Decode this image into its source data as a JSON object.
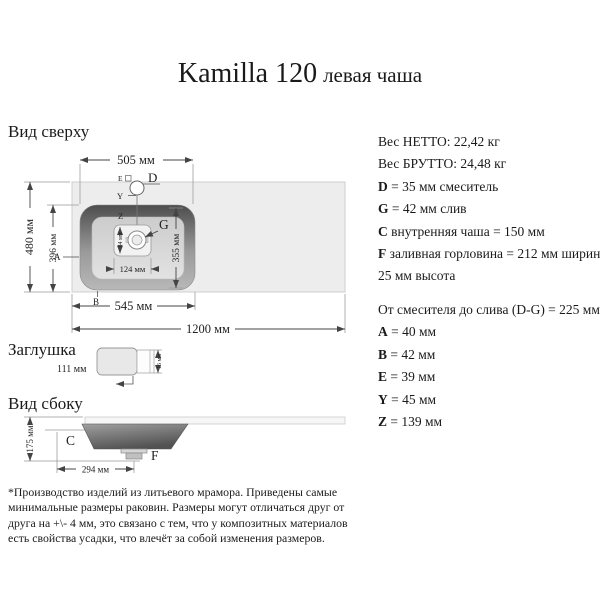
{
  "title": {
    "main": "Kamilla 120",
    "sub": "левая чаша"
  },
  "top_view": {
    "heading": "Вид сверху",
    "dims": {
      "bowl_width": "505 мм",
      "counter_height": "480 мм",
      "inner_height": "396 мм",
      "bowl_inner_depth": "355 мм",
      "drain_width": "124 мм",
      "drain_height": "84 мм",
      "left_width": "545 мм",
      "total_width": "1200 мм"
    },
    "labels": {
      "d": "D",
      "e": "E",
      "y": "Y",
      "z": "Z",
      "g": "G",
      "a": "A",
      "b": "B"
    }
  },
  "plug": {
    "heading": "Заглушка",
    "dims": {
      "width": "111 мм",
      "height": "16 мм"
    }
  },
  "side_view": {
    "heading": "Вид сбоку",
    "dims": {
      "height": "175 мм",
      "drain_offset": "294 мм"
    },
    "labels": {
      "c": "C",
      "f": "F"
    }
  },
  "specs1": [
    {
      "b": "",
      "t": "Вес НЕТТО: 22,42 кг"
    },
    {
      "b": "",
      "t": "Вес БРУТТО: 24,48 кг"
    },
    {
      "b": "D",
      "t": " = 35 мм смеситель"
    },
    {
      "b": "G",
      "t": " = 42 мм слив"
    },
    {
      "b": "C",
      "t": " внутренняя чаша = 150 мм"
    },
    {
      "b": "F",
      "t": " заливная горловина = 212 мм ширина,"
    },
    {
      "b": "",
      "t": "25 мм высота"
    }
  ],
  "specs2": [
    {
      "b": "",
      "t": "От смесителя до слива (D-G) = 225 мм"
    },
    {
      "b": "A",
      "t": " = 40 мм"
    },
    {
      "b": "B",
      "t": " = 42 мм"
    },
    {
      "b": "E",
      "t": " = 39 мм"
    },
    {
      "b": "Y",
      "t": " = 45 мм"
    },
    {
      "b": "Z",
      "t": " = 139 мм"
    }
  ],
  "footnote": "*Производство изделий из литьевого мрамора. Приведены самые минимальные размеры раковин. Размеры могут отличаться друг от друга на +\\- 4 мм, это связано с тем, что у композитных материалов есть свойства усадки, что влечёт за собой изменения размеров.",
  "colors": {
    "countertop": "#ededed",
    "bowl_dark": "#4d4d4d",
    "bowl_light": "#b8b8b8",
    "bowl_floor": "#d9d9d9",
    "dimension_line": "#555555"
  }
}
